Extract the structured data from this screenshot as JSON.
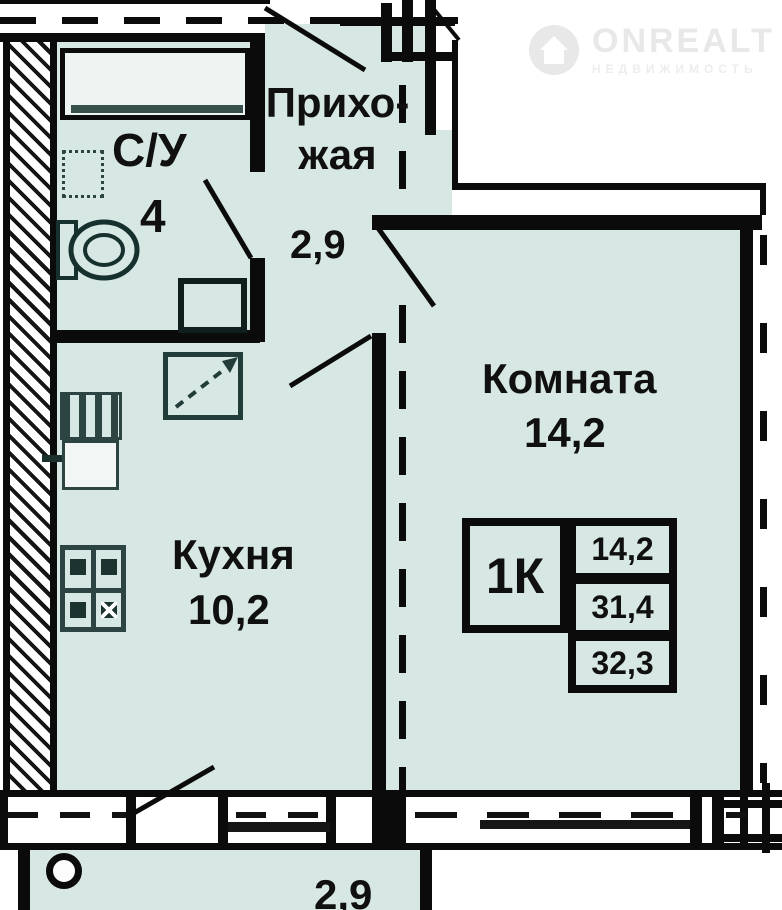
{
  "watermark": {
    "brand": "ONREALT",
    "subtitle": "НЕДВИЖИМОСТЬ"
  },
  "rooms": {
    "bathroom": {
      "label": "С/У",
      "area": "4"
    },
    "hallway": {
      "label_line1": "Прихо-",
      "label_line2": "жая",
      "area": "2,9"
    },
    "kitchen": {
      "label": "Кухня",
      "area": "10,2"
    },
    "living_room": {
      "label": "Комната",
      "area": "14,2"
    },
    "balcony": {
      "area": "2,9"
    }
  },
  "info_table": {
    "type": "1К",
    "living_area": "14,2",
    "floor_area": "31,4",
    "total_area": "32,3"
  },
  "colors": {
    "floor_fill": "#d7e7e3",
    "wall": "#0b0b0b",
    "fixture_dark": "#2c4542",
    "watermark_gray": "#e8e8e8"
  }
}
